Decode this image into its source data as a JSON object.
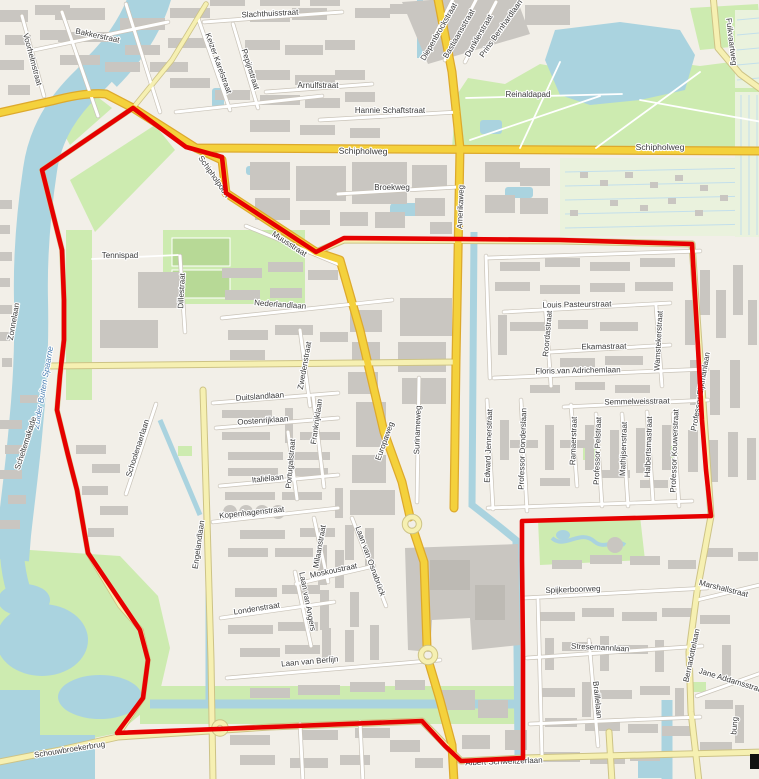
{
  "map": {
    "kind": "street-map-with-district-boundary",
    "colors": {
      "boundary": "#e60000",
      "water": "#aad3df",
      "park": "#cdebb0",
      "building": "#c9c6c1",
      "road_major": "#f4d13c",
      "road_secondary": "#f6f0b2",
      "land": "#f2efe8",
      "label": "#3b3b3b",
      "water_label": "#4d80b3"
    },
    "boundary": {
      "color": "#e60000",
      "points": [
        [
          133,
          108
        ],
        [
          186,
          147
        ],
        [
          222,
          157
        ],
        [
          226,
          193
        ],
        [
          316,
          252
        ],
        [
          344,
          238
        ],
        [
          460,
          239
        ],
        [
          560,
          240
        ],
        [
          692,
          244
        ],
        [
          697,
          330
        ],
        [
          702,
          420
        ],
        [
          706,
          470
        ],
        [
          711,
          516
        ],
        [
          522,
          521
        ],
        [
          522,
          560
        ],
        [
          523,
          650
        ],
        [
          523,
          758
        ],
        [
          461,
          761
        ],
        [
          445,
          746
        ],
        [
          422,
          721
        ],
        [
          270,
          727
        ],
        [
          117,
          733
        ],
        [
          143,
          698
        ],
        [
          148,
          660
        ],
        [
          140,
          630
        ],
        [
          88,
          553
        ],
        [
          77,
          490
        ],
        [
          68,
          455
        ],
        [
          57,
          410
        ],
        [
          60,
          375
        ],
        [
          64,
          340
        ],
        [
          64,
          300
        ],
        [
          62,
          250
        ],
        [
          52,
          210
        ],
        [
          42,
          170
        ]
      ]
    },
    "labels": [
      {
        "t": "Bakkerstraat",
        "x": 97,
        "y": 38,
        "r": 12
      },
      {
        "t": "Voorhelmstraat",
        "x": 30,
        "y": 60,
        "r": 75
      },
      {
        "t": "Slachthuisstraat",
        "x": 270,
        "y": 16,
        "r": -3
      },
      {
        "t": "Keizer Karelstraat",
        "x": 216,
        "y": 64,
        "r": 70
      },
      {
        "t": "Pepijnstraat",
        "x": 248,
        "y": 70,
        "r": 72
      },
      {
        "t": "Arnulfstraat",
        "x": 318,
        "y": 88,
        "r": 0
      },
      {
        "t": "Hannie Schaftstraat",
        "x": 390,
        "y": 113,
        "r": 0
      },
      {
        "t": "Diepenbrockstraat",
        "x": 441,
        "y": 33,
        "r": -60
      },
      {
        "t": "Bastiaansstraat",
        "x": 461,
        "y": 35,
        "r": -60
      },
      {
        "t": "Dunklerstraat",
        "x": 481,
        "y": 37,
        "r": -60
      },
      {
        "t": "Prins Bernhardlaan",
        "x": 503,
        "y": 30,
        "r": -55
      },
      {
        "t": "Reinaldapad",
        "x": 528,
        "y": 97,
        "r": 0
      },
      {
        "t": "Fuikvaartweg",
        "x": 729,
        "y": 42,
        "r": 83
      },
      {
        "t": "Schipholweg",
        "x": 363,
        "y": 154,
        "r": 1,
        "c": "big"
      },
      {
        "t": "Schipholweg",
        "x": 660,
        "y": 150,
        "r": 0,
        "c": "big"
      },
      {
        "t": "Schipholpoort",
        "x": 212,
        "y": 178,
        "r": 55
      },
      {
        "t": "Broekweg",
        "x": 392,
        "y": 190,
        "r": 0
      },
      {
        "t": "Amerikaweg",
        "x": 463,
        "y": 207,
        "r": -88
      },
      {
        "t": "Muusstraat",
        "x": 288,
        "y": 246,
        "r": 33
      },
      {
        "t": "Tennispad",
        "x": 120,
        "y": 258,
        "r": 0
      },
      {
        "t": "Dillestraat",
        "x": 184,
        "y": 291,
        "r": -87
      },
      {
        "t": "Nederlandlaan",
        "x": 280,
        "y": 307,
        "r": 4
      },
      {
        "t": "Zwedenstraat",
        "x": 307,
        "y": 366,
        "r": -80
      },
      {
        "t": "Zuider Buiten Spaarne",
        "x": 46,
        "y": 388,
        "r": -80,
        "c": "water"
      },
      {
        "t": "Zonnelaan",
        "x": 16,
        "y": 322,
        "r": -80
      },
      {
        "t": "Scheltemakade",
        "x": 28,
        "y": 444,
        "r": -72
      },
      {
        "t": "Schoolenaerlaan",
        "x": 140,
        "y": 449,
        "r": -72
      },
      {
        "t": "Duitslandlaan",
        "x": 260,
        "y": 399,
        "r": -4
      },
      {
        "t": "Oostenrijklaan",
        "x": 263,
        "y": 423,
        "r": -4
      },
      {
        "t": "Frankrijklaan",
        "x": 319,
        "y": 422,
        "r": -82
      },
      {
        "t": "Portugalstraat",
        "x": 293,
        "y": 464,
        "r": -85
      },
      {
        "t": "Italiëlaan",
        "x": 268,
        "y": 481,
        "r": -6
      },
      {
        "t": "Kopenhagenstraat",
        "x": 252,
        "y": 515,
        "r": -6
      },
      {
        "t": "Engelandlaan",
        "x": 201,
        "y": 545,
        "r": -82
      },
      {
        "t": "Europaweg",
        "x": 387,
        "y": 442,
        "r": -70
      },
      {
        "t": "Surinameweg",
        "x": 420,
        "y": 430,
        "r": -88
      },
      {
        "t": "Louis Pasteurstraat",
        "x": 577,
        "y": 307,
        "r": -1
      },
      {
        "t": "Roordastraat",
        "x": 550,
        "y": 334,
        "r": -85
      },
      {
        "t": "Ekamastraat",
        "x": 604,
        "y": 349,
        "r": -1
      },
      {
        "t": "Wamstekerstraat",
        "x": 661,
        "y": 341,
        "r": -87
      },
      {
        "t": "Floris van Adrichemlaan",
        "x": 578,
        "y": 373,
        "r": -1
      },
      {
        "t": "Semmelweisstraat",
        "x": 637,
        "y": 404,
        "r": -1
      },
      {
        "t": "Edward Jennerstraat",
        "x": 491,
        "y": 446,
        "r": -88
      },
      {
        "t": "Professor Donderslaan",
        "x": 525,
        "y": 449,
        "r": -88
      },
      {
        "t": "Ramaerstraat",
        "x": 576,
        "y": 441,
        "r": -88
      },
      {
        "t": "Professor Pelstraat",
        "x": 600,
        "y": 451,
        "r": -88
      },
      {
        "t": "Mathijsenstraat",
        "x": 626,
        "y": 449,
        "r": -88
      },
      {
        "t": "Halbertsmastraat",
        "x": 651,
        "y": 447,
        "r": -88
      },
      {
        "t": "Professor Kouwerstraat",
        "x": 677,
        "y": 451,
        "r": -88
      },
      {
        "t": "Professor Eijkmanlaan",
        "x": 703,
        "y": 392,
        "r": -80
      },
      {
        "t": "Milaanstraat",
        "x": 322,
        "y": 547,
        "r": -80
      },
      {
        "t": "Laan van Osnabrück",
        "x": 368,
        "y": 562,
        "r": 70
      },
      {
        "t": "Moskoustraat",
        "x": 334,
        "y": 573,
        "r": -12
      },
      {
        "t": "Londenstraat",
        "x": 257,
        "y": 611,
        "r": -9
      },
      {
        "t": "Laan van Angers",
        "x": 305,
        "y": 602,
        "r": 79
      },
      {
        "t": "Laan van Berlijn",
        "x": 310,
        "y": 664,
        "r": -5
      },
      {
        "t": "Schouwbroekerbrug",
        "x": 70,
        "y": 752,
        "r": -9
      },
      {
        "t": "Albert Schweitzerlaan",
        "x": 504,
        "y": 764,
        "r": -2
      },
      {
        "t": "Spijkerboorweg",
        "x": 573,
        "y": 592,
        "r": -2
      },
      {
        "t": "Stresemannlaan",
        "x": 600,
        "y": 650,
        "r": 3
      },
      {
        "t": "Braillelaan",
        "x": 595,
        "y": 700,
        "r": 84
      },
      {
        "t": "Marshallstraat",
        "x": 723,
        "y": 591,
        "r": 14
      },
      {
        "t": "Bernadottelaan",
        "x": 694,
        "y": 656,
        "r": -78
      },
      {
        "t": "Jane Addamsstraat",
        "x": 731,
        "y": 683,
        "r": 17
      },
      {
        "t": "bung",
        "x": 737,
        "y": 726,
        "r": -85
      }
    ],
    "artifacts": [
      {
        "x": 750,
        "y": 754,
        "w": 9,
        "h": 15
      }
    ]
  }
}
